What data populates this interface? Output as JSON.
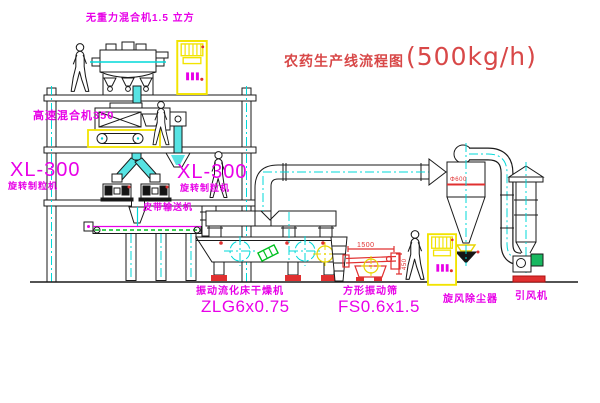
{
  "title": {
    "cn": "农药生产线流程图",
    "capacity": "(500kg/h)"
  },
  "labels": {
    "gravity_mixer": "无重力混合机1.5 立方",
    "high_speed_mixer": "高速混合机350",
    "granulator_left_model": "XL-300",
    "granulator_left_name": "旋转制粒机",
    "granulator_right_model": "XL-300",
    "granulator_right_name": "旋转制粒机",
    "belt_conveyor": "皮带输送机",
    "dryer_name": "振动流化床干燥机",
    "dryer_model": "ZLG6x0.75",
    "sieve_name": "方形振动筛",
    "sieve_model": "FS0.6x1.5",
    "cyclone": "旋风除尘器",
    "fan": "引风机"
  },
  "dims": {
    "d1500": "1500",
    "d450": "450",
    "cyclone_dia": "Φ600"
  },
  "colors": {
    "label_magenta": "#e800e8",
    "title_red": "#d84848",
    "machine_red": "#e03030",
    "centerline_cyan": "#00d8d8",
    "pipe_fill_cyan": "#57e3e3",
    "cabinet_yellow": "#f2e400",
    "motor_green": "#18b860",
    "line_black": "#1a1a1a"
  }
}
